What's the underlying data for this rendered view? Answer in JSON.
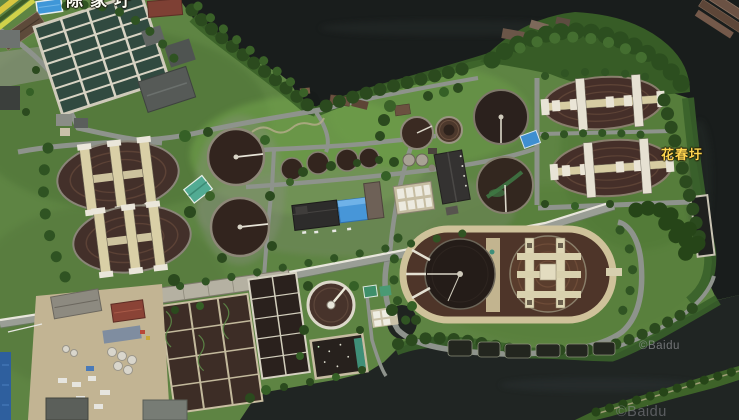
{
  "map": {
    "view": "satellite",
    "labels": {
      "top_partial": "陈家圩",
      "place": "花春圩"
    },
    "watermarks": [
      {
        "text": "©Baidu"
      },
      {
        "text": "©Baidu"
      }
    ],
    "colors": {
      "water_dark": "#191d1c",
      "water_river": "#202523",
      "grass": "#5e8443",
      "tree": "#2b4a1e",
      "road": "#8e938c",
      "pipeline_white": "#e8e6dc",
      "tank_interior_brown": "#43302a",
      "tank_interior_dark": "#241c18",
      "walkway_tan": "#d9cfa6",
      "bridge_white": "#e9e5d9",
      "sedimentation_cell_teal": "#314a40",
      "roof_blue": "#4796d8",
      "roof_teal": "#52ab93",
      "roof_red": "#8a4336",
      "place_label_yellow": "#ffd54f",
      "town_label_white": "#fdfdf5",
      "watermark_gray": "#a0a0a5"
    },
    "features": [
      "running-track",
      "swimming-pool",
      "sedimentation-tank-grid",
      "oxidation-ditch-west-1",
      "oxidation-ditch-west-2",
      "oxidation-ditch-east-1",
      "oxidation-ditch-east-2",
      "clarifier-west-1",
      "clarifier-west-2",
      "clarifier-center-1",
      "clarifier-center-2",
      "clarifier-medium-1",
      "clarifier-medium-2",
      "small-tank-row",
      "giant-clarifier-pair",
      "sludge-thickener",
      "sludge-drying-bed",
      "aeration-basin-complex",
      "filter-gallery",
      "blue-roof-building",
      "teal-roof-building",
      "long-dark-building",
      "narrow-basin-east",
      "industrial-yard",
      "pipeline-road",
      "river",
      "tree-cover",
      "barges",
      "docks"
    ]
  }
}
